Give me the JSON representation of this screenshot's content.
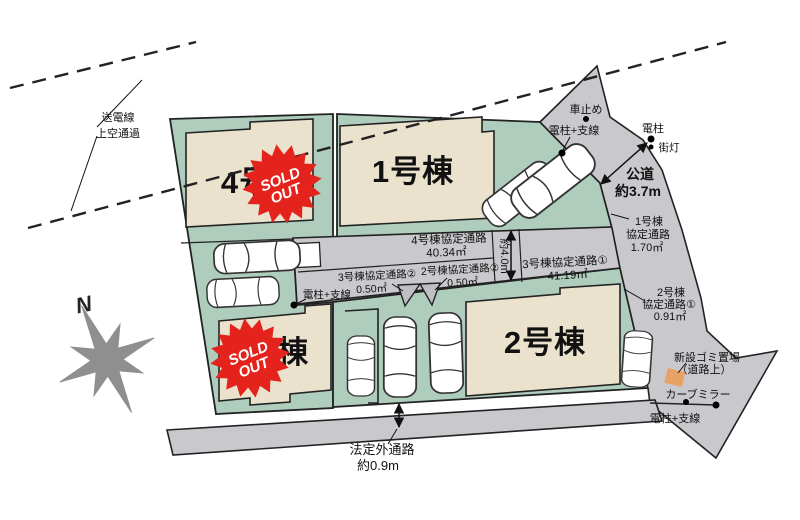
{
  "colors": {
    "lot_green": "#aecdbd",
    "building_beige": "#eae2cc",
    "road_gray": "#c9c9cd",
    "stamp_red": "#e3231c",
    "trash_orange": "#e8a266",
    "compass_gray": "#8f8f8f"
  },
  "compass": {
    "north_label": "N"
  },
  "power_line": {
    "line1": "送電線",
    "line2": "上空通過"
  },
  "buildings": {
    "b1": {
      "label": "1号棟",
      "sold": false
    },
    "b2": {
      "label": "2号棟",
      "sold": false
    },
    "b3": {
      "label": "3号棟",
      "sold": true
    },
    "b4": {
      "label": "4号棟",
      "sold": true
    }
  },
  "stamp": {
    "line1": "SOLD",
    "line2": "OUT"
  },
  "roads": {
    "public_road": {
      "line1": "公道",
      "line2": "約3.7m"
    },
    "r1": {
      "line1": "1号棟",
      "line2": "協定通路",
      "line3": "1.70㎡"
    },
    "r2a": {
      "line1": "2号棟",
      "line2": "協定通路①",
      "line3": "0.91㎡"
    },
    "r2b": {
      "line1": "2号棟協定通路②",
      "line2": "0.50㎡"
    },
    "r3a": {
      "line1": "3号棟協定通路①",
      "line2": "41.19㎡"
    },
    "r3b": {
      "line1": "3号棟協定通路②",
      "line2": "0.50㎡"
    },
    "r4": {
      "line1": "4号棟協定通路",
      "line2": "40.34㎡"
    },
    "width_40": "約4.0m",
    "hotei": {
      "line1": "法定外通路",
      "line2": "約0.9m"
    }
  },
  "markers": {
    "car_stop": "車止め",
    "pole_wire_top": "電柱+支線",
    "pole": "電柱",
    "street_light": "街灯",
    "pole_wire_mid": "電柱+支線",
    "trash": {
      "line1": "新設ゴミ置場",
      "line2": "（道路上）"
    },
    "curve_mirror": "カーブミラー",
    "pole_wire_bottom": "電柱+支線"
  }
}
